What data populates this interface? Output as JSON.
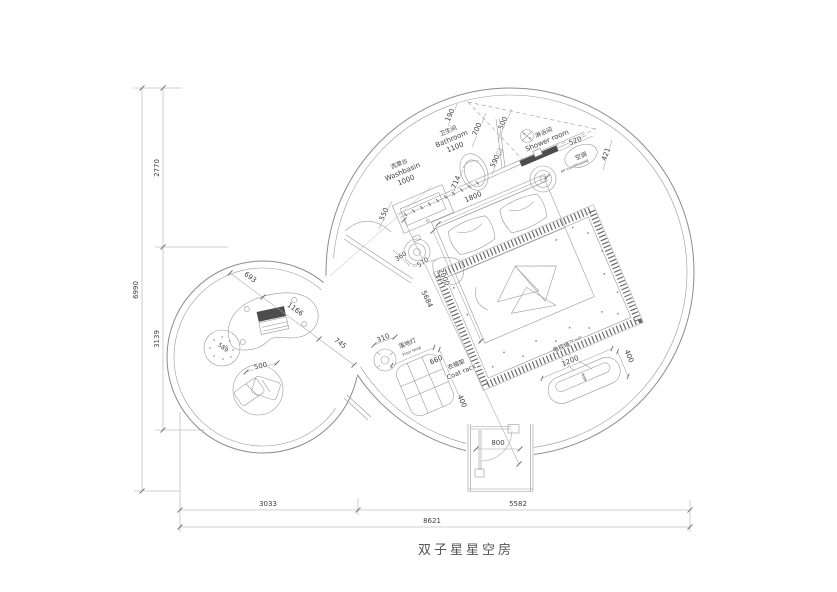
{
  "title": "双子星星空房",
  "colors": {
    "line": "#8c8c8c",
    "text": "#3f3f3f",
    "glass_dark": "#4d4d4d",
    "background": "#ffffff"
  },
  "rooms": {
    "bathroom": {
      "zh": "卫生间",
      "en": "Bathroom",
      "width": "1100"
    },
    "washbasin": {
      "zh": "洗漱台",
      "en": "Washbasin",
      "width": "1000"
    },
    "shower": {
      "zh": "淋浴间",
      "en": "Shower room"
    },
    "ac": {
      "zh": "空调",
      "en": "air conditioning"
    },
    "tv": {
      "zh": "电视墙",
      "en": "TV wall",
      "unit": "电视机",
      "width": "1200",
      "depth": "400"
    },
    "coat_rack": {
      "zh": "衣帽架",
      "en": "Coat rack",
      "width": "660",
      "depth": "400"
    },
    "floor_lamp": {
      "zh": "落地灯",
      "en": "Floor lamp",
      "size": "310"
    }
  },
  "dims": {
    "overall_w": "8621",
    "w_left": "3033",
    "w_right": "5582",
    "overall_h": "6990",
    "h_top": "2770",
    "h_bottom": "3139",
    "top_wall": "190",
    "bath_shower_gap": "700",
    "shower_edge": "500",
    "shower_glass": "520",
    "ac_side": "421",
    "shower_door": "590",
    "toilet_side": "714",
    "bed_head": "1800",
    "basin_side": "550",
    "stool_a": "360",
    "stool_b": "570",
    "bed_side": "2000",
    "diag": "5684",
    "entry_door": "800",
    "lounge_seg1": "693",
    "lounge_seg2": "1166",
    "lounge_seg3": "745",
    "pouf": "589",
    "cushion": "500"
  }
}
